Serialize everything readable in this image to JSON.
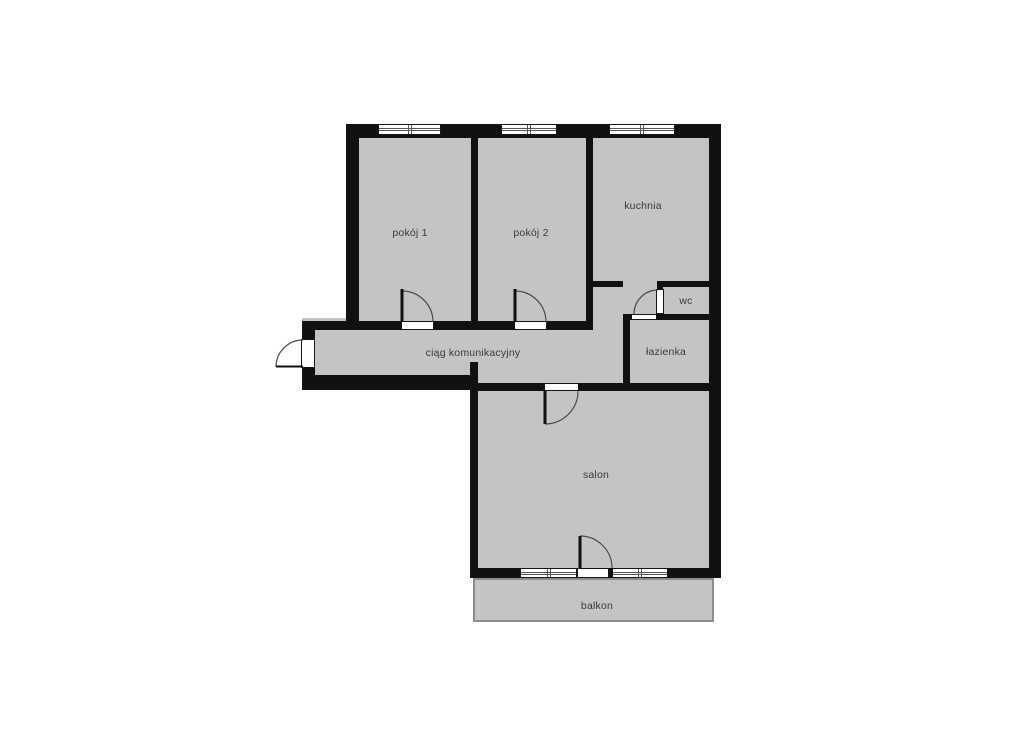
{
  "colors": {
    "floor": "#c4c4c4",
    "wall": "#111111",
    "label": "#3a3a3a",
    "arc": "#4a4a4a",
    "balcony-border": "#8c8c8c",
    "background": "#ffffff"
  },
  "rooms": [
    {
      "id": "pokoj-1",
      "label": "pokój 1"
    },
    {
      "id": "pokoj-2",
      "label": "pokój 2"
    },
    {
      "id": "kuchnia",
      "label": "kuchnia"
    },
    {
      "id": "wc",
      "label": "wc"
    },
    {
      "id": "lazienka",
      "label": "łazienka"
    },
    {
      "id": "ciag-komunikacyjny",
      "label": "ciąg komunikacyjny"
    },
    {
      "id": "salon",
      "label": "salon"
    },
    {
      "id": "balkon",
      "label": "balkon"
    }
  ]
}
